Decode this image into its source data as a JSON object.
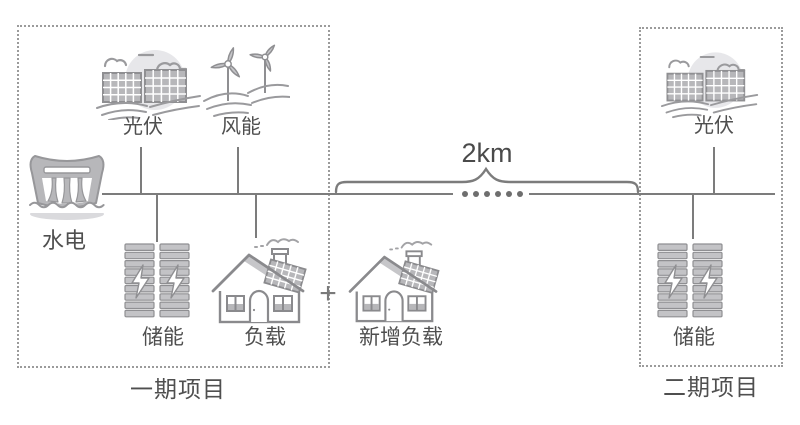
{
  "diagram_title": "microgrid-two-phase-diagram",
  "colors": {
    "background": "#ffffff",
    "line_gray": "#7c7c7c",
    "border_gray": "#9b9b9b",
    "icon_stroke": "#8f8f92",
    "icon_fill": "#b7b7ba",
    "text_gray": "#4f4f4f"
  },
  "phase1": {
    "title": "一期项目",
    "pv_label": "光伏",
    "wind_label": "风能",
    "hydro_label": "水电",
    "storage_label": "储能",
    "load_label": "负载"
  },
  "phase2": {
    "title": "二期项目",
    "pv_label": "光伏",
    "storage_label": "储能"
  },
  "interconnect": {
    "distance_label": "2km",
    "plus_sign": "+",
    "new_load_label": "新增负载"
  },
  "icons": {
    "pv": "solar-panel-icon",
    "wind": "wind-turbine-icon",
    "hydro": "hydro-dam-icon",
    "storage": "battery-storage-icon",
    "load": "house-load-icon",
    "distance": "curly-brace-icon",
    "bus_break": "dotted-bus-gap"
  }
}
